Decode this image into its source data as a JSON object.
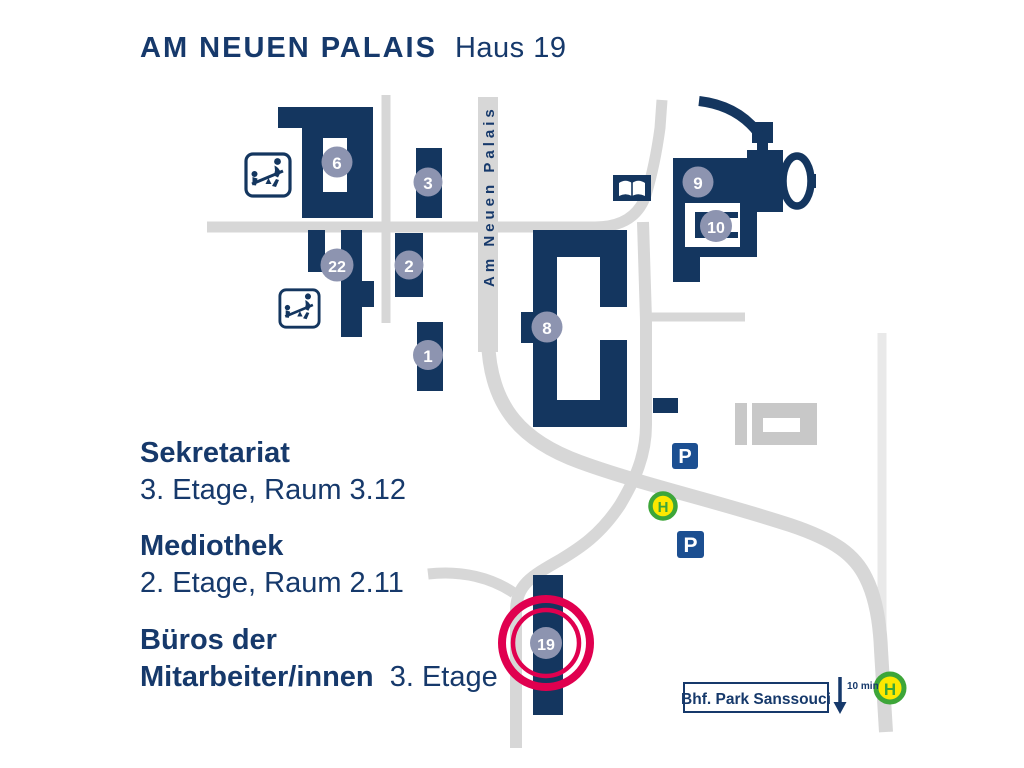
{
  "title": {
    "campus": "AM NEUEN PALAIS",
    "house": "Haus 19"
  },
  "street": {
    "name": "Am Neuen Palais"
  },
  "info_sections": [
    {
      "name": "Sekretariat",
      "detail": "3. Etage, Raum 3.12"
    },
    {
      "name": "Mediothek",
      "detail": "2. Etage, Raum 2.11"
    },
    {
      "name": "Büros der",
      "name2": "Mitarbeiter/innen",
      "detail": "3. Etage"
    }
  ],
  "badges": [
    {
      "label": "6"
    },
    {
      "label": "3"
    },
    {
      "label": "22"
    },
    {
      "label": "2"
    },
    {
      "label": "1"
    },
    {
      "label": "8"
    },
    {
      "label": "9"
    },
    {
      "label": "10"
    },
    {
      "label": "19"
    }
  ],
  "station": {
    "label": "Bhf. Park Sanssouci",
    "walk_time": "10 min"
  },
  "map_icons": {
    "bus_stop_letter": "H",
    "parking_letter": "P",
    "book_icon": "mediothek-library",
    "playground_icon": "seesaw-playground"
  },
  "colors": {
    "building_navy": "#14365f",
    "text_navy": "#16396b",
    "badge_gray_blue": "#8d94b0",
    "road_gray": "#d7d7d7",
    "road_light_gray": "#e9e9e9",
    "gray_building": "#c8c8c8",
    "highlight_red": "#e0004f",
    "parking_blue": "#1c4f91",
    "bus_green": "#3da639",
    "bus_yellow": "#fde800"
  }
}
